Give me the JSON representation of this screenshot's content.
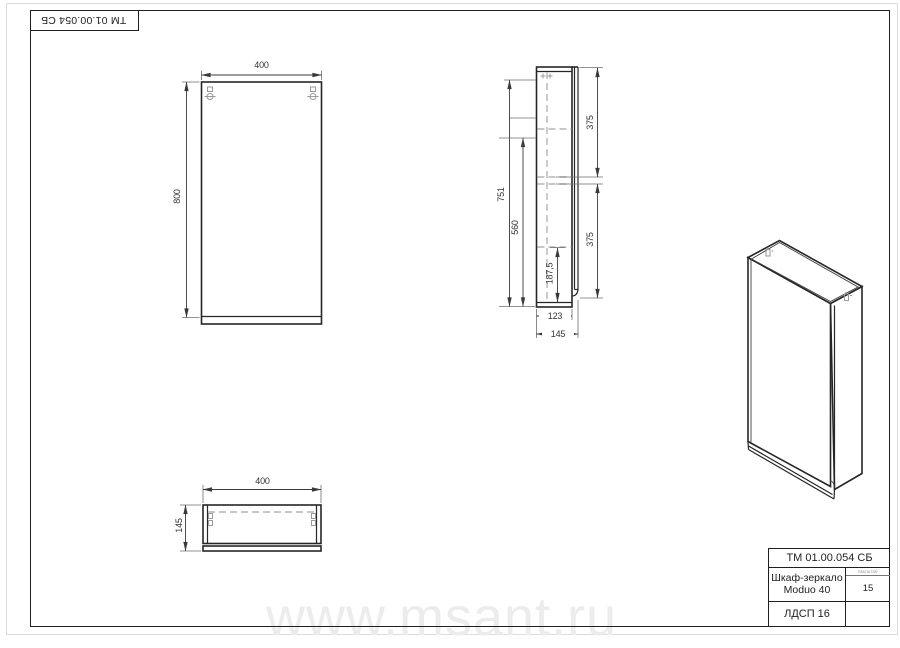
{
  "page": {
    "watermark_text": "www.msant.ru"
  },
  "corner_stamp": {
    "code": "ТМ 01.00.054 СБ"
  },
  "title_block": {
    "doc_code": "ТМ 01.00.054 СБ",
    "product_name_line1": "Шкаф-зеркало",
    "product_name_line2": "Moduo 40",
    "scale_label": "Масштаб",
    "scale_value": "15",
    "material": "ЛДСП 16"
  },
  "dimensions": {
    "front_view": {
      "width": "400",
      "height": "800"
    },
    "side_view": {
      "inner_height": "751",
      "mid_height": "560",
      "half_section": "187,5",
      "upper_section": "375",
      "lower_section": "375",
      "body_depth": "123",
      "total_depth": "145"
    },
    "bottom_view": {
      "width": "400",
      "depth": "145"
    }
  }
}
